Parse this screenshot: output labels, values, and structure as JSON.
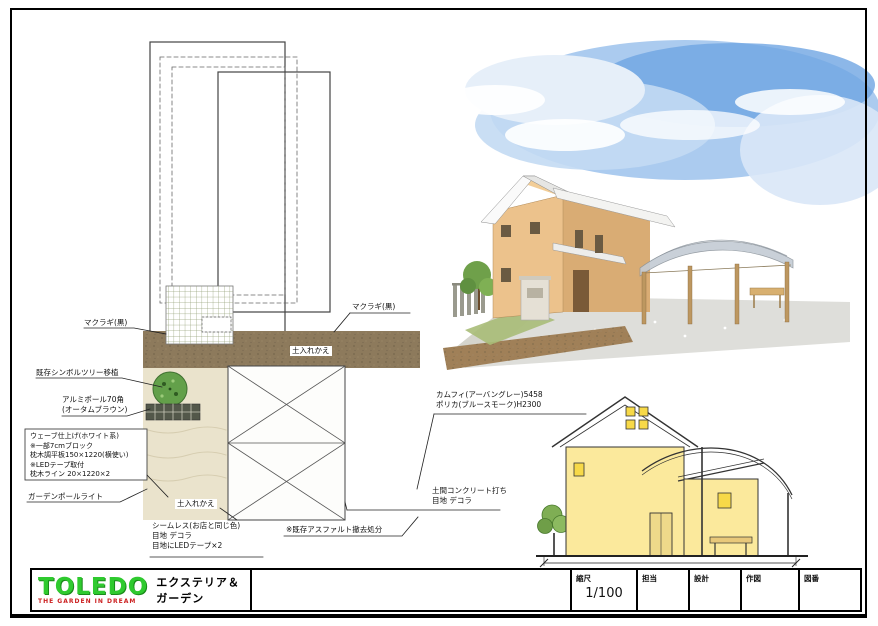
{
  "title_block": {
    "logo_text": "TOLEDO",
    "logo_subtitle": "THE GARDEN IN DREAM",
    "company_tagline": "エクステリア＆ガーデン",
    "fields": [
      {
        "label": "縮尺",
        "value": "1/100"
      },
      {
        "label": "担当",
        "value": ""
      },
      {
        "label": "設計",
        "value": ""
      },
      {
        "label": "作図",
        "value": ""
      },
      {
        "label": "図番",
        "value": ""
      }
    ]
  },
  "plan": {
    "labels": {
      "makuragi_left": "マクラギ(黒)",
      "makuragi_top": "マクラギ(黒)",
      "existing_tree": "既存シンボルツリー移植",
      "alu_pole": "アルミポール70角\n(オータムブラウン)",
      "wave_block": "ウェーブ仕上げ(ホワイト系)\n※一部7cmブロック\n枕木調平板150×1220(横使い)\n※LEDテープ取付\n枕木ライン 20×1220×2",
      "soil_top": "土入れかえ",
      "soil_bottom": "土入れかえ",
      "garden_light": "ガーデンポールライト",
      "seamless": "シームレス(お店と同じ色)\n目地 デコラ\n目地にLEDテープ×2",
      "asphalt": "※既存アスファルト撤去処分"
    }
  },
  "annotations": {
    "carport": "カムフィ(アーバングレー)5458\nポリカ(ブルースモーク)H2300",
    "concrete": "土間コンクリート打ち\n目地 デコラ"
  }
}
